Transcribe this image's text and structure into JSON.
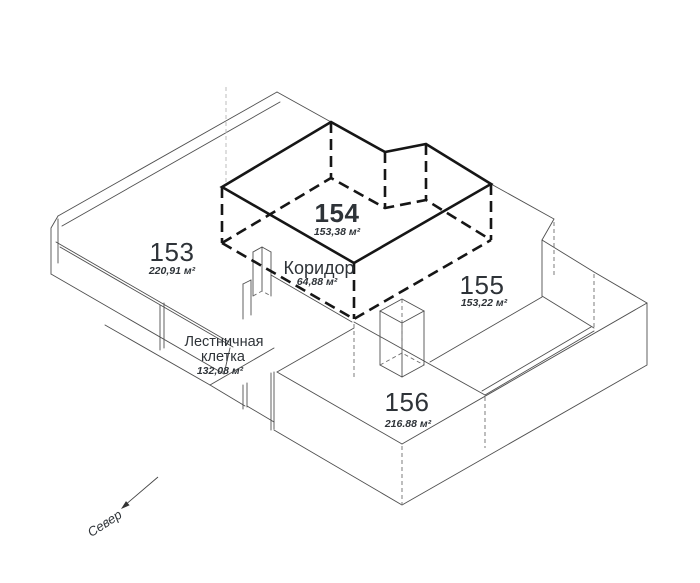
{
  "diagram": {
    "type": "isometric-floor-plan",
    "rooms": {
      "r153": {
        "number": "153",
        "area": "220,91 м²",
        "highlighted": false
      },
      "r154": {
        "number": "154",
        "area": "153,38 м²",
        "highlighted": true
      },
      "r155": {
        "number": "155",
        "area": "153,22 м²",
        "highlighted": false
      },
      "r156": {
        "number": "156",
        "area": "216.88 м²",
        "highlighted": false
      },
      "corridor": {
        "name": "Коридор",
        "area": "64,88 м²"
      },
      "staircase": {
        "name_line1": "Лестничная",
        "name_line2": "клетка",
        "area": "132,08 м²"
      }
    },
    "compass": {
      "label": "Север"
    },
    "colors": {
      "bold": "#161616",
      "thin": "#4f4f4f",
      "thin_dashed": "#6e6e6e",
      "faint": "#b5b5b5",
      "text": "#2e3338",
      "background": "#ffffff"
    }
  }
}
